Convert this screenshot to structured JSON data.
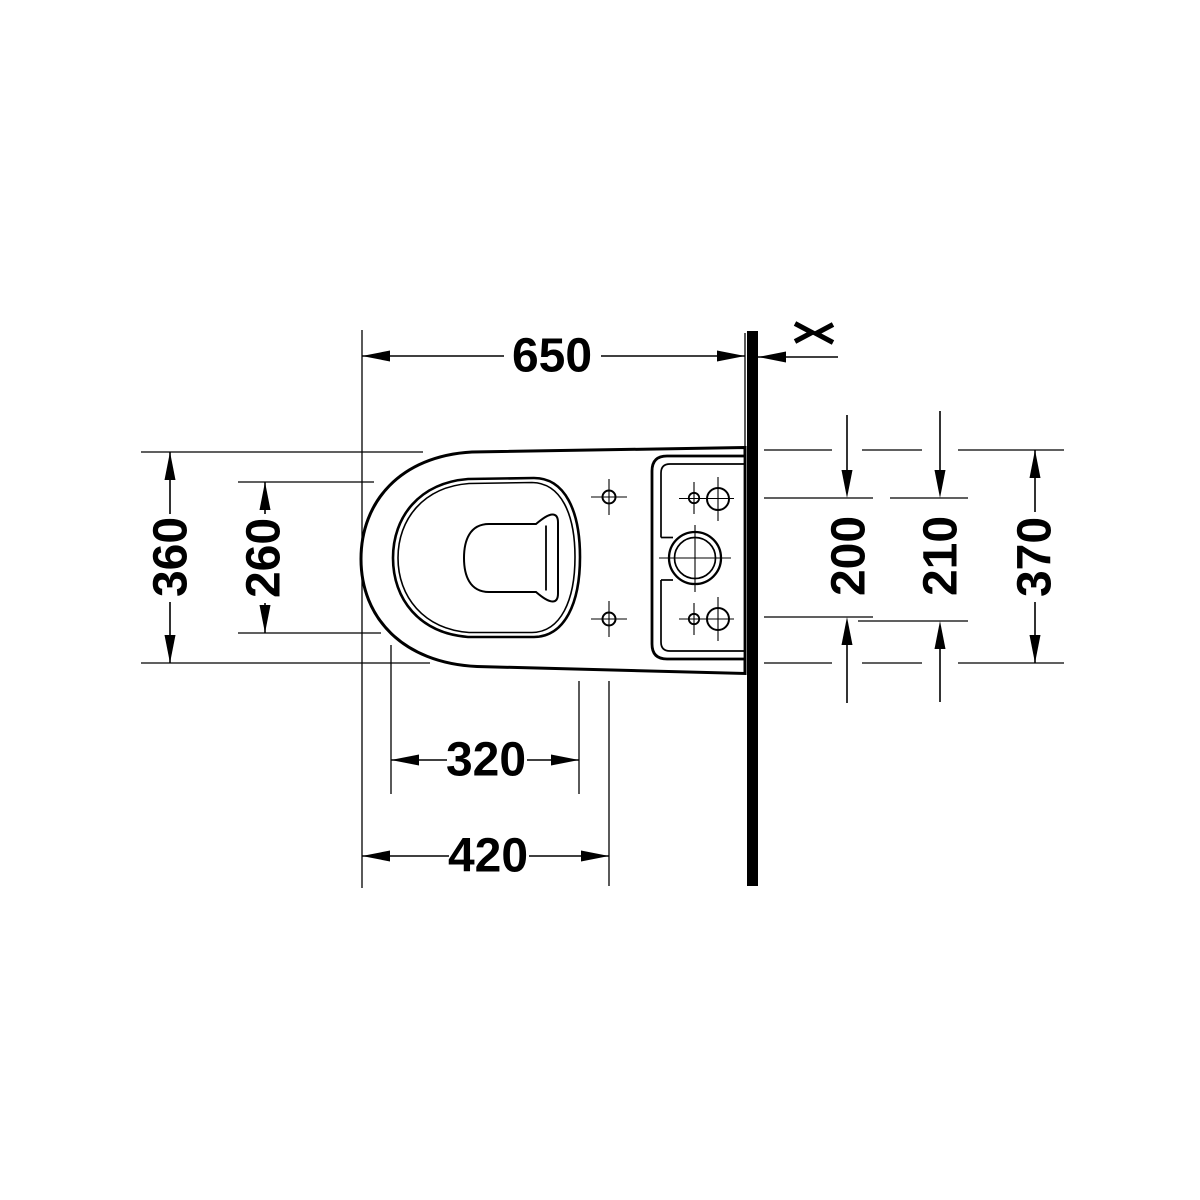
{
  "page": {
    "background": "#ffffff",
    "ink": "#000000"
  },
  "drawing": {
    "kind": "technical plan-view dimension drawing of close-coupled toilet at wall",
    "labels": {
      "d650": "650",
      "d360": "360",
      "d260": "260",
      "d320": "320",
      "d420": "420",
      "d200": "200",
      "d210": "210",
      "d370": "370"
    }
  }
}
